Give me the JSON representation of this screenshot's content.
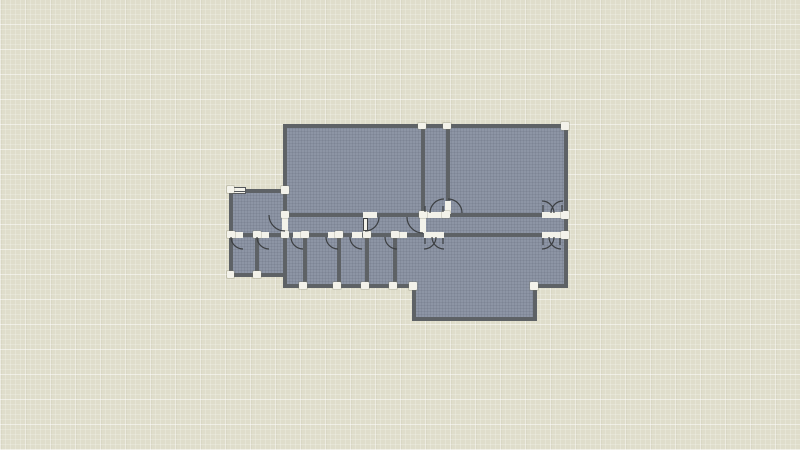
{
  "app": {
    "view": "floor-plan-canvas"
  },
  "colors": {
    "bg": "#dfddcb",
    "floor": "#8d95a5",
    "wall": "#5e6266",
    "opening": "#f3f2ea",
    "node": "#f3f2ea",
    "symbol": "#3c3f42",
    "window_frame": "#55585c"
  }
}
